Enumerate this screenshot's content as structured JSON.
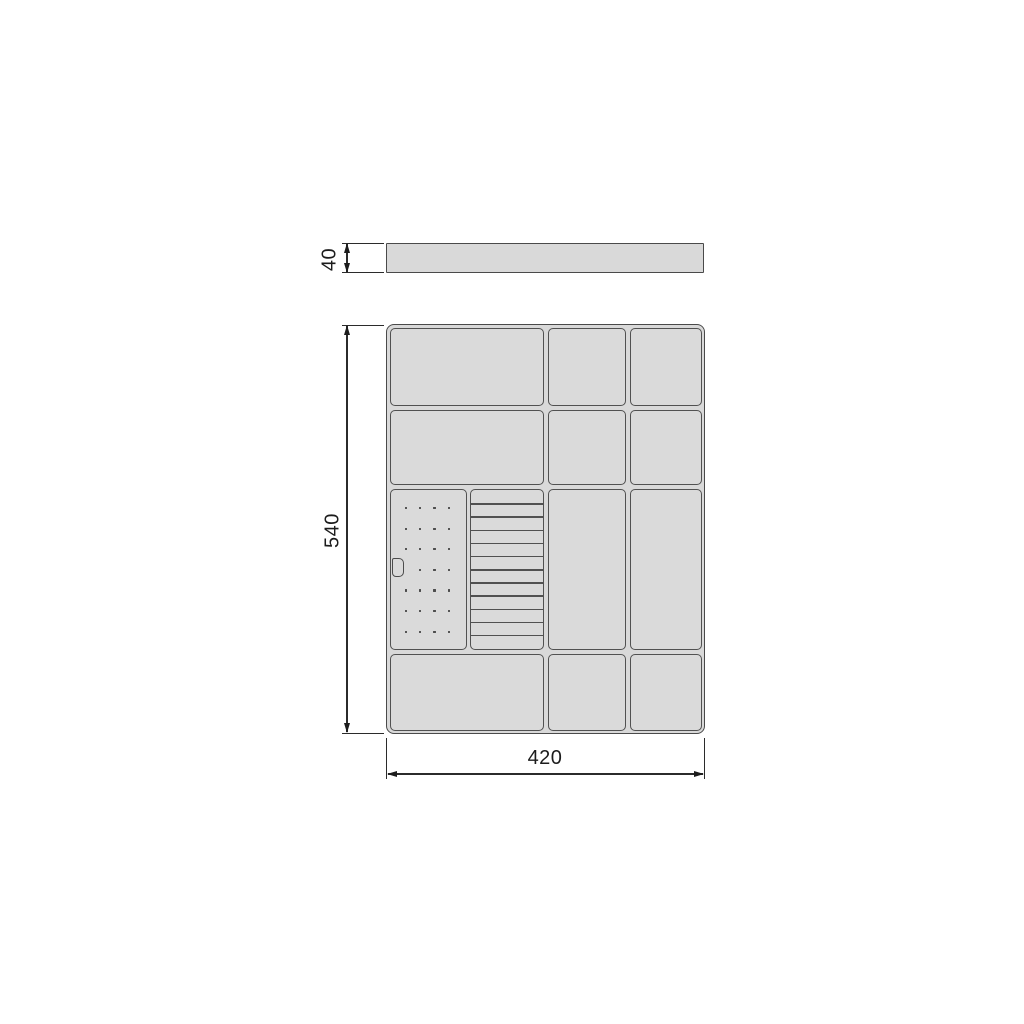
{
  "drawing": {
    "type": "technical-drawing",
    "subject": "drawer cutlery tray organizer, front/side view and top view",
    "colors": {
      "background": "#ffffff",
      "part_fill": "#d9d9d9",
      "part_outline": "#4a4a4a",
      "divider_outline": "#515151",
      "dimension_lines": "#2b2b2b"
    },
    "dimensions": {
      "thickness": {
        "label": "40",
        "orientation": "vertical",
        "applies_to": "side-view bar height"
      },
      "height": {
        "label": "540",
        "orientation": "vertical",
        "applies_to": "top-view tray depth"
      },
      "width": {
        "label": "420",
        "orientation": "horizontal",
        "applies_to": "top-view tray width"
      }
    },
    "top_view": {
      "grid": {
        "columns": 3,
        "rows": 4,
        "compartments": [
          "row1: wide-left, middle, right",
          "row2: wide-left, middle, right",
          "row3: peg-panel + knife-block (left), tall-middle, tall-right",
          "row4: wide-left, middle, right"
        ]
      },
      "knife_block": {
        "slat_lines": 11,
        "slots": 12
      },
      "peg_panel": {
        "dot_rows": 7,
        "dot_cols": 4,
        "skipped_dot": {
          "row": 3,
          "col": 0
        },
        "has_clip_shape": true
      }
    }
  }
}
